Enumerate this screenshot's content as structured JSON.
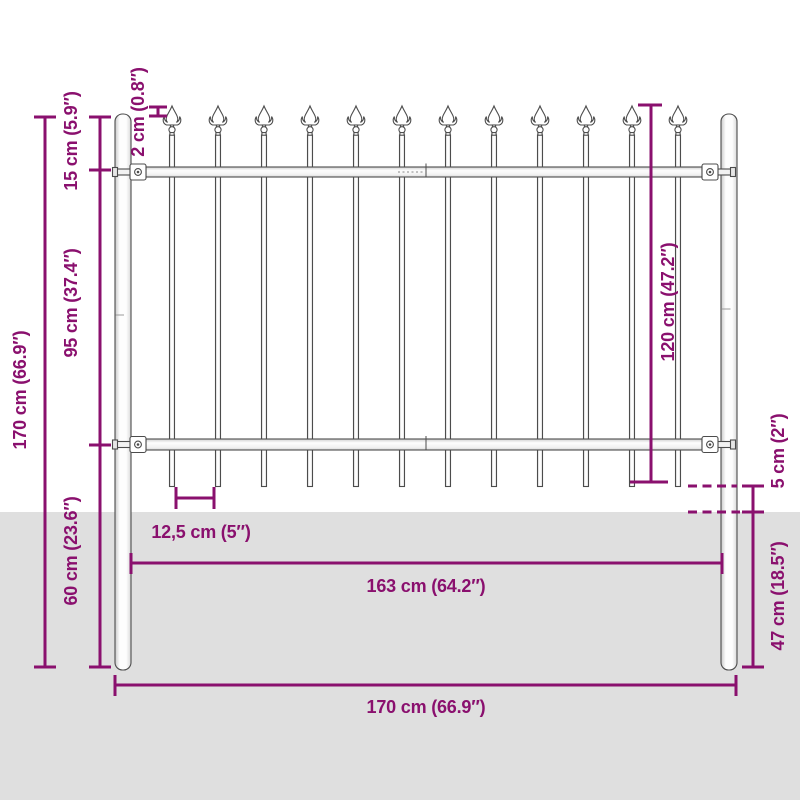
{
  "colors": {
    "dimension_purple": "#8a106e",
    "fence_outline": "#4c4c4c",
    "fence_fill": "#ffffff",
    "ground_gray": "#dfdfdf",
    "background": "#ffffff"
  },
  "fence": {
    "picket_count": 12,
    "first_picket_x": 172,
    "picket_spacing_px": 46,
    "spear_tip_y": 106
  },
  "dimensions": {
    "total_height": "170 cm (66.9″)",
    "top_rail_offset": "15 cm (5.9″)",
    "rail_to_rail": "95 cm (37.4″)",
    "post_below_rail": "60 cm (23.6″)",
    "spear_above_post": "2 cm (0.8″)",
    "panel_height": "120 cm (47.2″)",
    "picket_ground_gap": "5 cm (2″)",
    "post_below_ground": "47 cm (18.5″)",
    "picket_spacing": "12,5 cm (5″)",
    "panel_width": "163 cm (64.2″)",
    "total_width": "170 cm (66.9″)"
  }
}
